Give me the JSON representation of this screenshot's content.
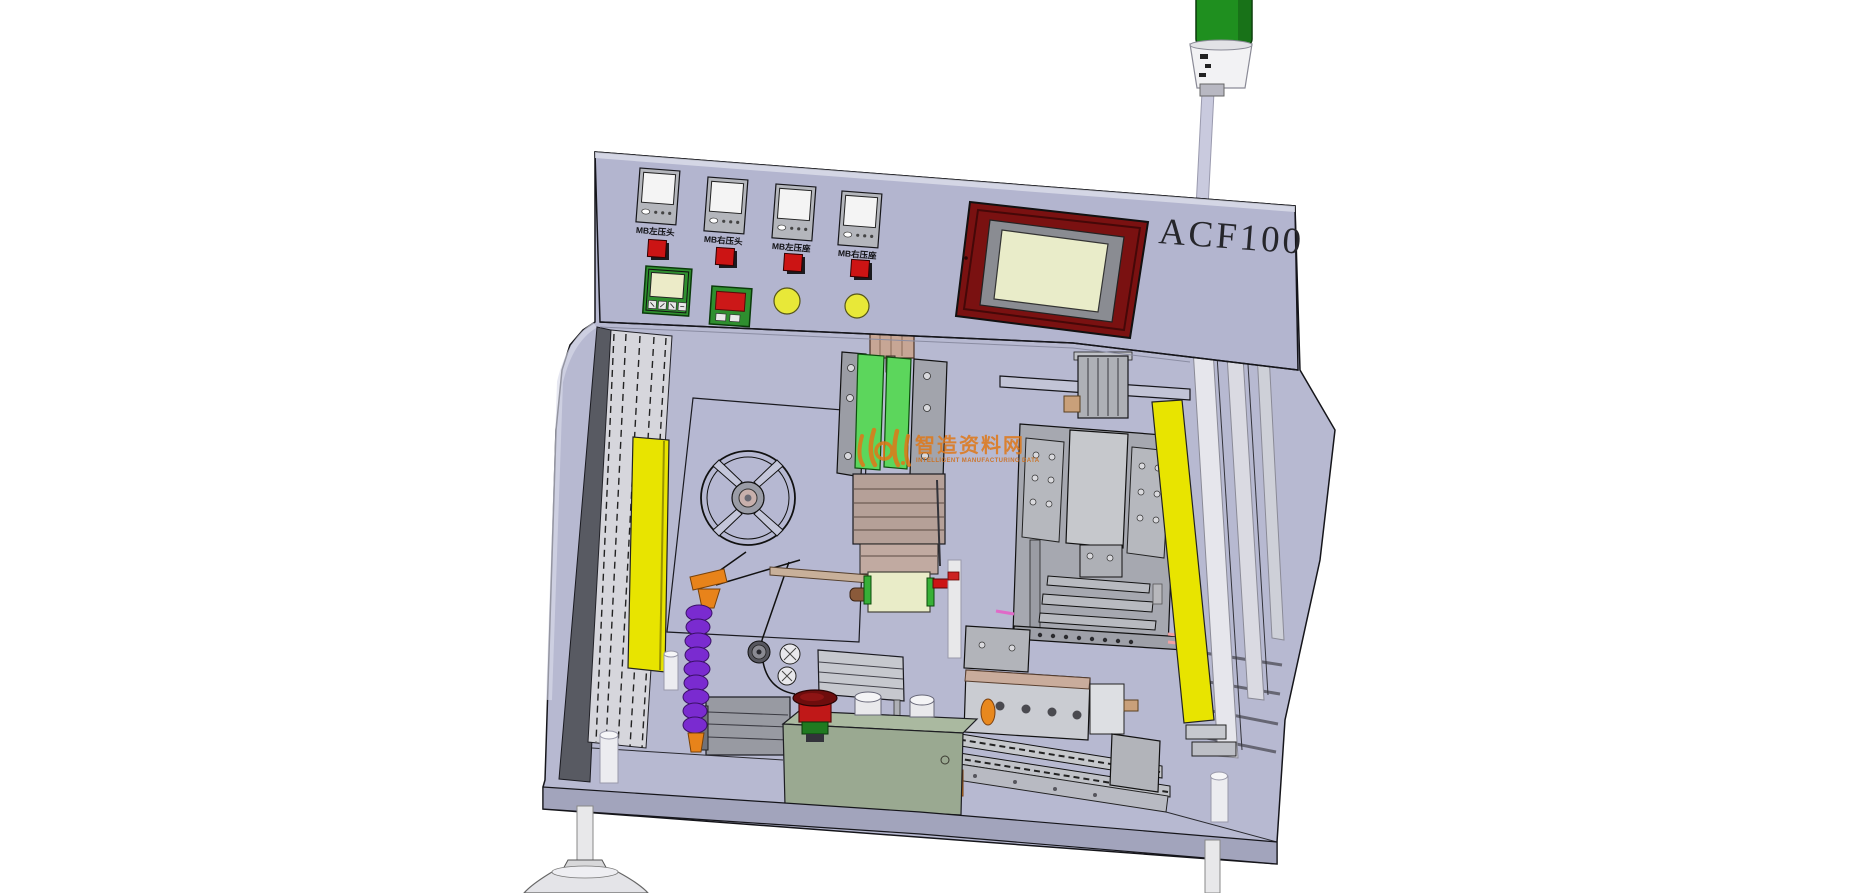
{
  "machine": {
    "model_label": "ACF100",
    "control_panel": {
      "controllers": [
        {
          "label": "MB左压头"
        },
        {
          "label": "MB右压头"
        },
        {
          "label": "MB左压座"
        },
        {
          "label": "MB右压座"
        }
      ]
    }
  },
  "watermark": {
    "title_cn": "智造资料网",
    "subtitle_en": "INTELLIGENT MANUFACTURING DATA"
  },
  "colors": {
    "panel": "#b3b5cf",
    "body": "#b7b9d1",
    "curtain": "#e8e400",
    "tower_lens": "#1f8f1f",
    "hmi_bezel": "#7a1111",
    "hmi_screen": "#e9ecc9",
    "indicator_red": "#cc1414",
    "button_yellow": "#e8e838",
    "slide_green": "#5cd65c",
    "hose_purple": "#7a2bd0",
    "watermark_orange": "#e07818",
    "enclosure_green": "#9aa991",
    "bowl_red": "#c01818"
  }
}
